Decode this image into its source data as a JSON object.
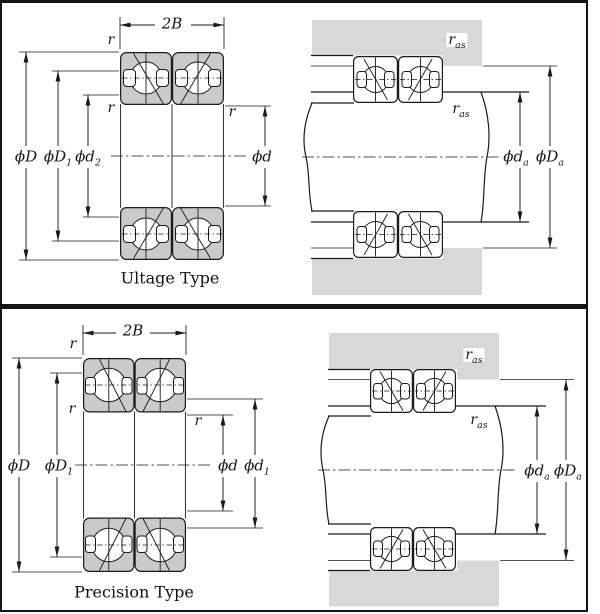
{
  "colors": {
    "line": "#1a1a1a",
    "ring": "#c9cac9",
    "housing": "#d8d8d8",
    "bg": "#ffffff",
    "frame": "#141414"
  },
  "top": {
    "title": "Ultage Type",
    "section": {
      "b2": {
        "base": "2B",
        "sub": ""
      },
      "r_outer": {
        "base": "r",
        "sub": ""
      },
      "r_front": {
        "base": "r",
        "sub": ""
      },
      "r_bore": {
        "base": "r",
        "sub": ""
      },
      "dD": {
        "base": "ϕD",
        "sub": ""
      },
      "dD1": {
        "base": "ϕD",
        "sub": "1"
      },
      "dd2": {
        "base": "ϕd",
        "sub": "2"
      },
      "dd": {
        "base": "ϕd",
        "sub": ""
      }
    },
    "mounting": {
      "ras_housing": {
        "base": "r",
        "sub": "as"
      },
      "ras_shaft": {
        "base": "r",
        "sub": "as"
      },
      "dda": {
        "base": "ϕd",
        "sub": "a"
      },
      "dDa": {
        "base": "ϕD",
        "sub": "a"
      }
    }
  },
  "bottom": {
    "title": "Precision Type",
    "section": {
      "b2": {
        "base": "2B",
        "sub": ""
      },
      "r_outer": {
        "base": "r",
        "sub": ""
      },
      "r_front": {
        "base": "r",
        "sub": ""
      },
      "r_bore": {
        "base": "r",
        "sub": ""
      },
      "dD": {
        "base": "ϕD",
        "sub": ""
      },
      "dD1": {
        "base": "ϕD",
        "sub": "1"
      },
      "dd": {
        "base": "ϕd",
        "sub": ""
      },
      "dd1": {
        "base": "ϕd",
        "sub": "1"
      }
    },
    "mounting": {
      "ras_housing": {
        "base": "r",
        "sub": "as"
      },
      "ras_shaft": {
        "base": "r",
        "sub": "as"
      },
      "dda": {
        "base": "ϕd",
        "sub": "a"
      },
      "dDa": {
        "base": "ϕD",
        "sub": "a"
      }
    }
  }
}
